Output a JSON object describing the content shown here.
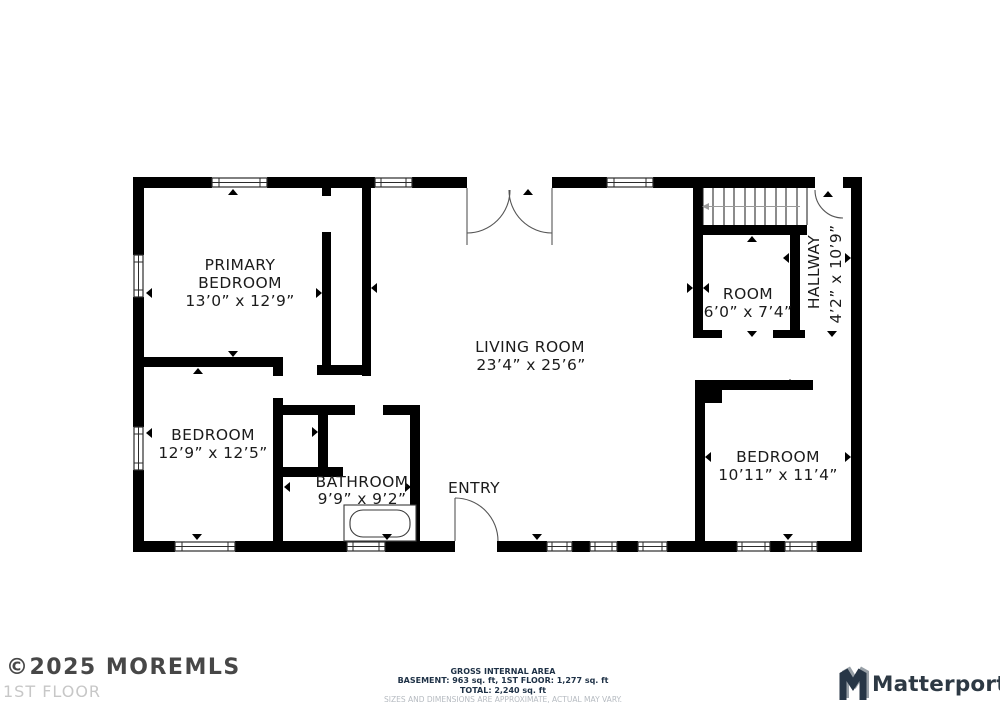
{
  "floorplan": {
    "rooms": {
      "primary_bedroom": {
        "line1": "PRIMARY",
        "line2": "BEDROOM",
        "dims": "13’0” x 12’9”"
      },
      "bedroom_left": {
        "name": "BEDROOM",
        "dims": "12’9” x 12’5”"
      },
      "bathroom": {
        "name": "BATHROOM",
        "dims": "9’9” x 9’2”"
      },
      "living_room": {
        "name": "LIVING ROOM",
        "dims": "23’4” x 25’6”"
      },
      "entry": {
        "name": "ENTRY"
      },
      "room": {
        "name": "ROOM",
        "dims": "6’0” x 7’4”"
      },
      "hallway": {
        "name": "HALLWAY",
        "dims": "4’2” x 10’9”"
      },
      "bedroom_right": {
        "name": "BEDROOM",
        "dims": "10’11” x 11’4”"
      }
    }
  },
  "footer": {
    "copyright": "©2025 MOREMLS",
    "floor_label": "1ST FLOOR",
    "gross_title": "GROSS INTERNAL AREA",
    "area_line": "BASEMENT: 963 sq. ft, 1ST FLOOR: 1,277 sq. ft",
    "total_line": "TOTAL: 2,240 sq. ft",
    "disclaimer": "SIZES AND DIMENSIONS ARE APPROXIMATE, ACTUAL MAY VARY.",
    "brand": "Matterport"
  },
  "colors": {
    "wall": "#000000",
    "label_text": "#1b1b1b",
    "footer_dark": "#1e3146",
    "footer_muted": "#b6bbc1",
    "brand_text": "#2d3944"
  }
}
